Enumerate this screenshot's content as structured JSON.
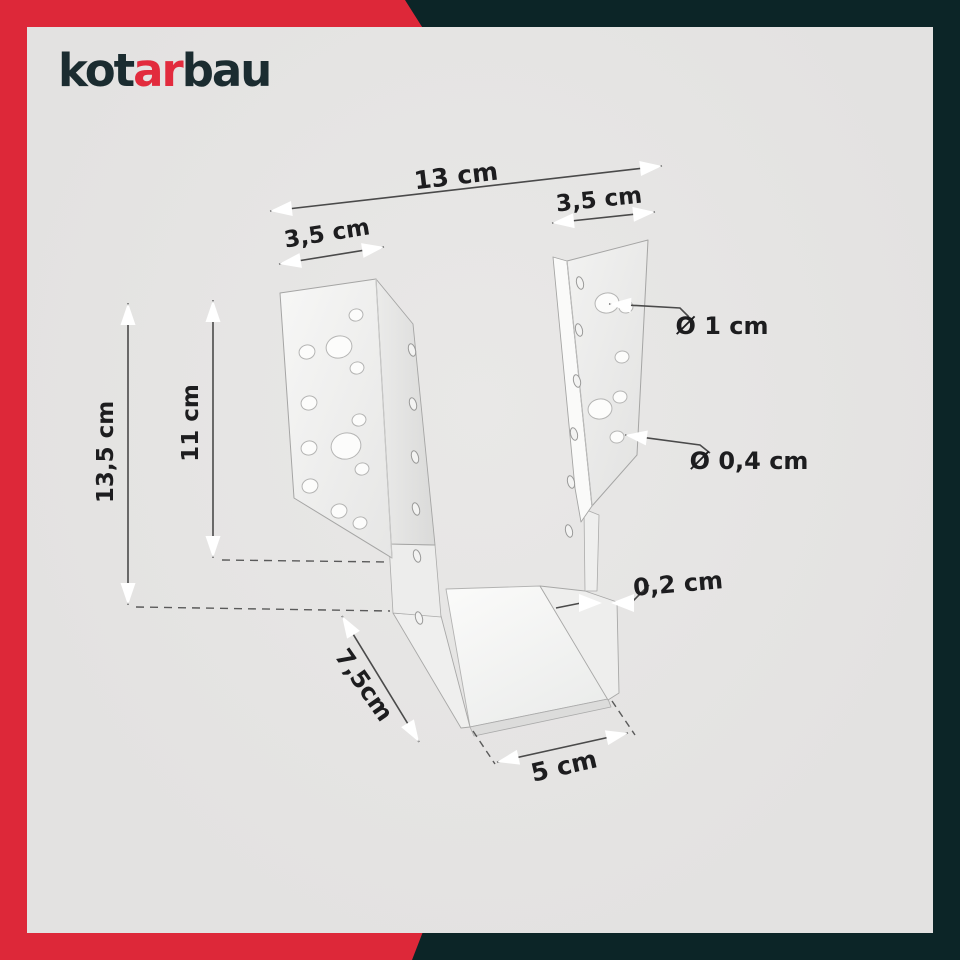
{
  "brand": {
    "logo_prefix": "kot",
    "logo_accent": "ar",
    "logo_suffix": "bau"
  },
  "diagram": {
    "subject": "joist-hanger-dimension-diagram",
    "dimensions": {
      "total_width": "13 cm",
      "left_flange_width": "3,5 cm",
      "right_flange_width": "3,5 cm",
      "large_hole_diameter": "Ø 1 cm",
      "small_hole_diameter": "Ø 0,4 cm",
      "total_height": "13,5 cm",
      "flange_height": "11 cm",
      "material_thickness": "0,2 cm",
      "depth": "7,5cm",
      "inner_width": "5 cm"
    }
  },
  "colors": {
    "accent_red": "#dd2839",
    "dark_teal": "#0c2527",
    "canvas_gray": "#e4e3e2",
    "label_text": "#1d1d1f",
    "metal_light": "#f6f6f5"
  }
}
